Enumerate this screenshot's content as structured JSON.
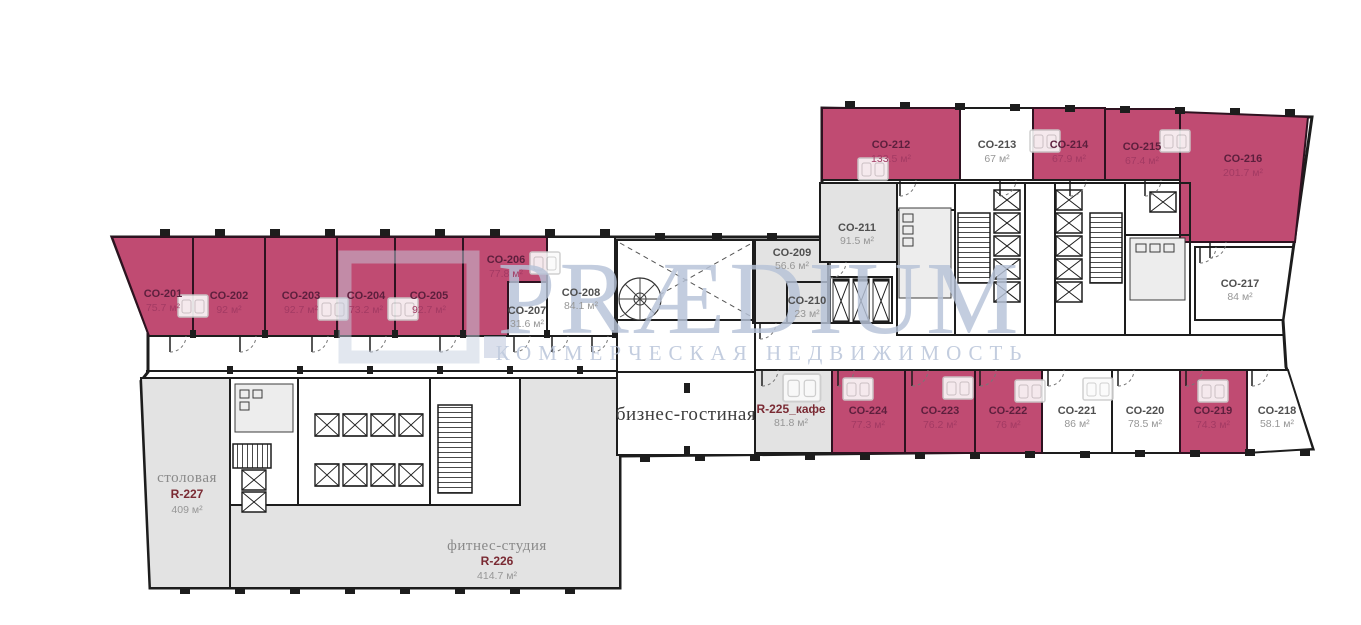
{
  "palette": {
    "highlight": "#c04b72",
    "service": "#e3e3e3",
    "wall": "#1d1d1d",
    "watermark": "#b7c3d8"
  },
  "watermark": {
    "brand": "PRÆDIUM",
    "tagline": "КОММЕРЧЕСКАЯ НЕДВИЖИМОСТЬ"
  },
  "rooms": [
    {
      "id": "CO-201",
      "area": "75.7 м²",
      "status": "highlighted"
    },
    {
      "id": "CO-202",
      "area": "92 м²",
      "status": "highlighted"
    },
    {
      "id": "CO-203",
      "area": "92.7 м²",
      "status": "highlighted"
    },
    {
      "id": "CO-204",
      "area": "73.2 м²",
      "status": "highlighted"
    },
    {
      "id": "CO-205",
      "area": "92.7 м²",
      "status": "highlighted"
    },
    {
      "id": "CO-206",
      "area": "77.8 м²",
      "status": "highlighted"
    },
    {
      "id": "CO-207",
      "area": "31.6 м²",
      "status": "plain"
    },
    {
      "id": "CO-208",
      "area": "84.1 м²",
      "status": "plain"
    },
    {
      "id": "CO-209",
      "area": "56.6 м²",
      "status": "service"
    },
    {
      "id": "CO-210",
      "area": "23 м²",
      "status": "service"
    },
    {
      "id": "CO-211",
      "area": "91.5 м²",
      "status": "service"
    },
    {
      "id": "CO-212",
      "area": "133.5 м²",
      "status": "highlighted"
    },
    {
      "id": "CO-213",
      "area": "67 м²",
      "status": "plain"
    },
    {
      "id": "CO-214",
      "area": "67.9 м²",
      "status": "highlighted"
    },
    {
      "id": "CO-215",
      "area": "67.4 м²",
      "status": "highlighted"
    },
    {
      "id": "CO-216",
      "area": "201.7 м²",
      "status": "highlighted"
    },
    {
      "id": "CO-217",
      "area": "84 м²",
      "status": "plain"
    },
    {
      "id": "CO-218",
      "area": "58.1 м²",
      "status": "plain"
    },
    {
      "id": "CO-219",
      "area": "74.3 м²",
      "status": "highlighted"
    },
    {
      "id": "CO-220",
      "area": "78.5 м²",
      "status": "plain"
    },
    {
      "id": "CO-221",
      "area": "86 м²",
      "status": "plain"
    },
    {
      "id": "CO-222",
      "area": "76 м²",
      "status": "highlighted"
    },
    {
      "id": "CO-223",
      "area": "76.2 м²",
      "status": "highlighted"
    },
    {
      "id": "CO-224",
      "area": "77.3 м²",
      "status": "highlighted"
    }
  ],
  "zones": {
    "cafe": {
      "id": "R-225_кафе",
      "area": "81.8 м²"
    },
    "business_lounge": {
      "name": "бизнес-гостиная"
    },
    "canteen": {
      "name": "столовая",
      "id": "R-227",
      "area": "409 м²"
    },
    "fitness": {
      "name": "фитнес-студия",
      "id": "R-226",
      "area": "414.7 м²"
    }
  }
}
